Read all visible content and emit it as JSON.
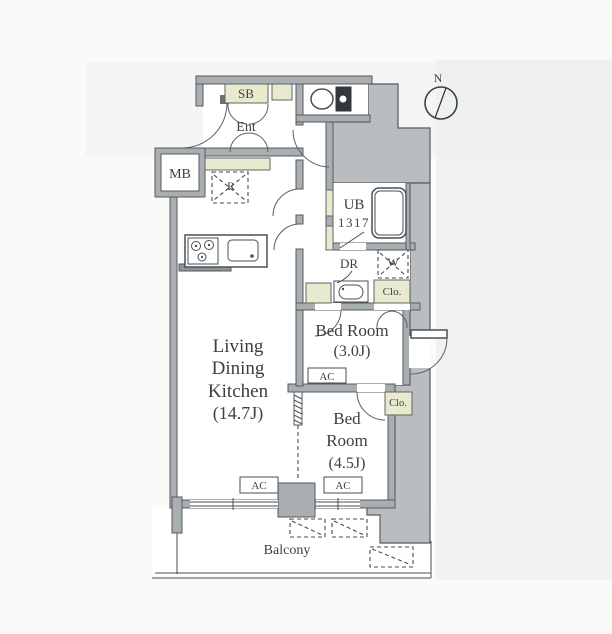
{
  "floor_plan": {
    "compass": {
      "north_label": "N"
    },
    "rooms": {
      "living_dining_kitchen": {
        "line1": "Living",
        "line2": "Dining",
        "line3": "Kitchen",
        "size": "(14.7J)"
      },
      "bedroom_3j": {
        "name": "Bed Room",
        "size": "(3.0J)"
      },
      "bedroom_45j": {
        "line1": "Bed",
        "line2": "Room",
        "size": "(4.5J)"
      },
      "balcony": {
        "name": "Balcony"
      },
      "entrance": {
        "name": "Ent"
      },
      "unit_bath": {
        "line1": "UB",
        "line2": "1317"
      },
      "powder_room": {
        "name": "DR"
      }
    },
    "fixtures": {
      "shoe_box": "SB",
      "meter_box": "MB",
      "refrigerator": "R",
      "washer": "W",
      "closet": "Clo.",
      "air_conditioner": "AC"
    },
    "colors": {
      "wall_gray": "#a9aeb1",
      "corridor_gray": "#b9bdbf",
      "accent_beige": "#e9e9cd",
      "line_dark": "#45494d",
      "background": "#fafaf9"
    }
  }
}
